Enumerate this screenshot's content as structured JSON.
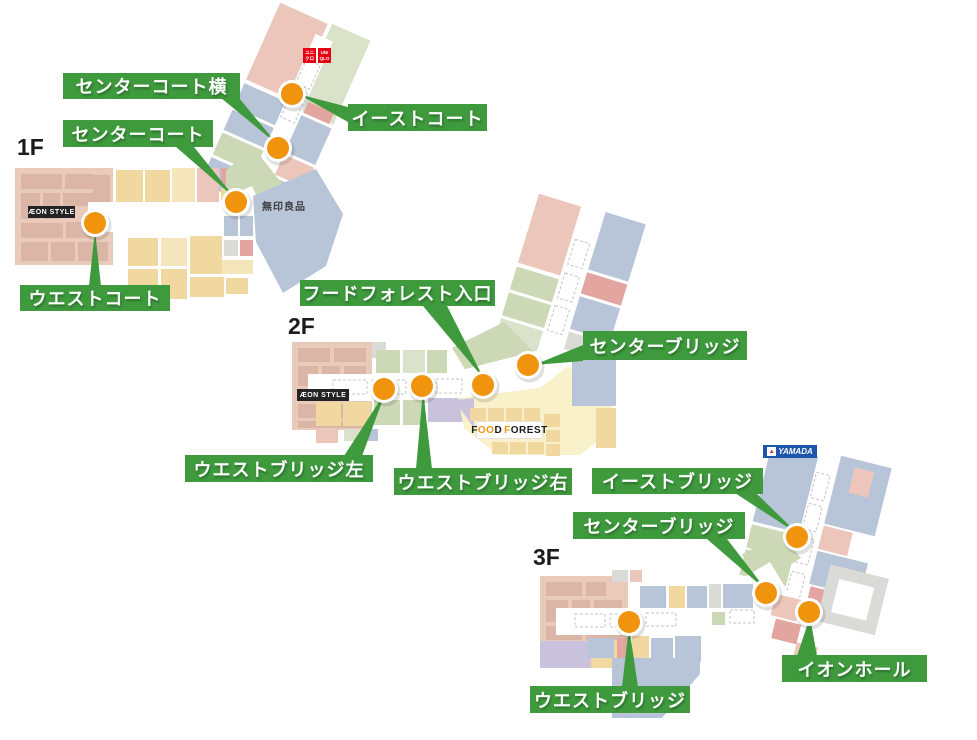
{
  "page": {
    "background": "#ffffff"
  },
  "colors": {
    "label_green": "#3e9a3d",
    "marker_orange": "#f0930d",
    "uniqlo_red": "#e60012",
    "yamada_blue": "#1e56ac"
  },
  "floors": [
    {
      "title": "1F",
      "markers": [
        {
          "label": "イーストコート"
        },
        {
          "label": "センターコート横"
        },
        {
          "label": "センターコート"
        },
        {
          "label": "ウエストコート"
        }
      ],
      "stores": {
        "aeon": "ÆON STYLE",
        "muji": "無印良品",
        "uniqlo_jp1": "ユニ",
        "uniqlo_jp2": "クロ",
        "uniqlo_en1": "UNI",
        "uniqlo_en2": "QLO"
      }
    },
    {
      "title": "2F",
      "markers": [
        {
          "label": "フードフォレスト入口"
        },
        {
          "label": "センターブリッジ"
        },
        {
          "label": "ウエストブリッジ左"
        },
        {
          "label": "ウエストブリッジ右"
        }
      ],
      "stores": {
        "aeon": "ÆON STYLE",
        "ff1": "F",
        "ff2": "OO",
        "ff3": "D",
        "ff4": "F",
        "ff5": "OREST"
      }
    },
    {
      "title": "3F",
      "markers": [
        {
          "label": "イーストブリッジ"
        },
        {
          "label": "センターブリッジ"
        },
        {
          "label": "イオンホール"
        },
        {
          "label": "ウエストブリッジ"
        }
      ],
      "stores": {
        "yamada": "YAMADA"
      }
    }
  ]
}
